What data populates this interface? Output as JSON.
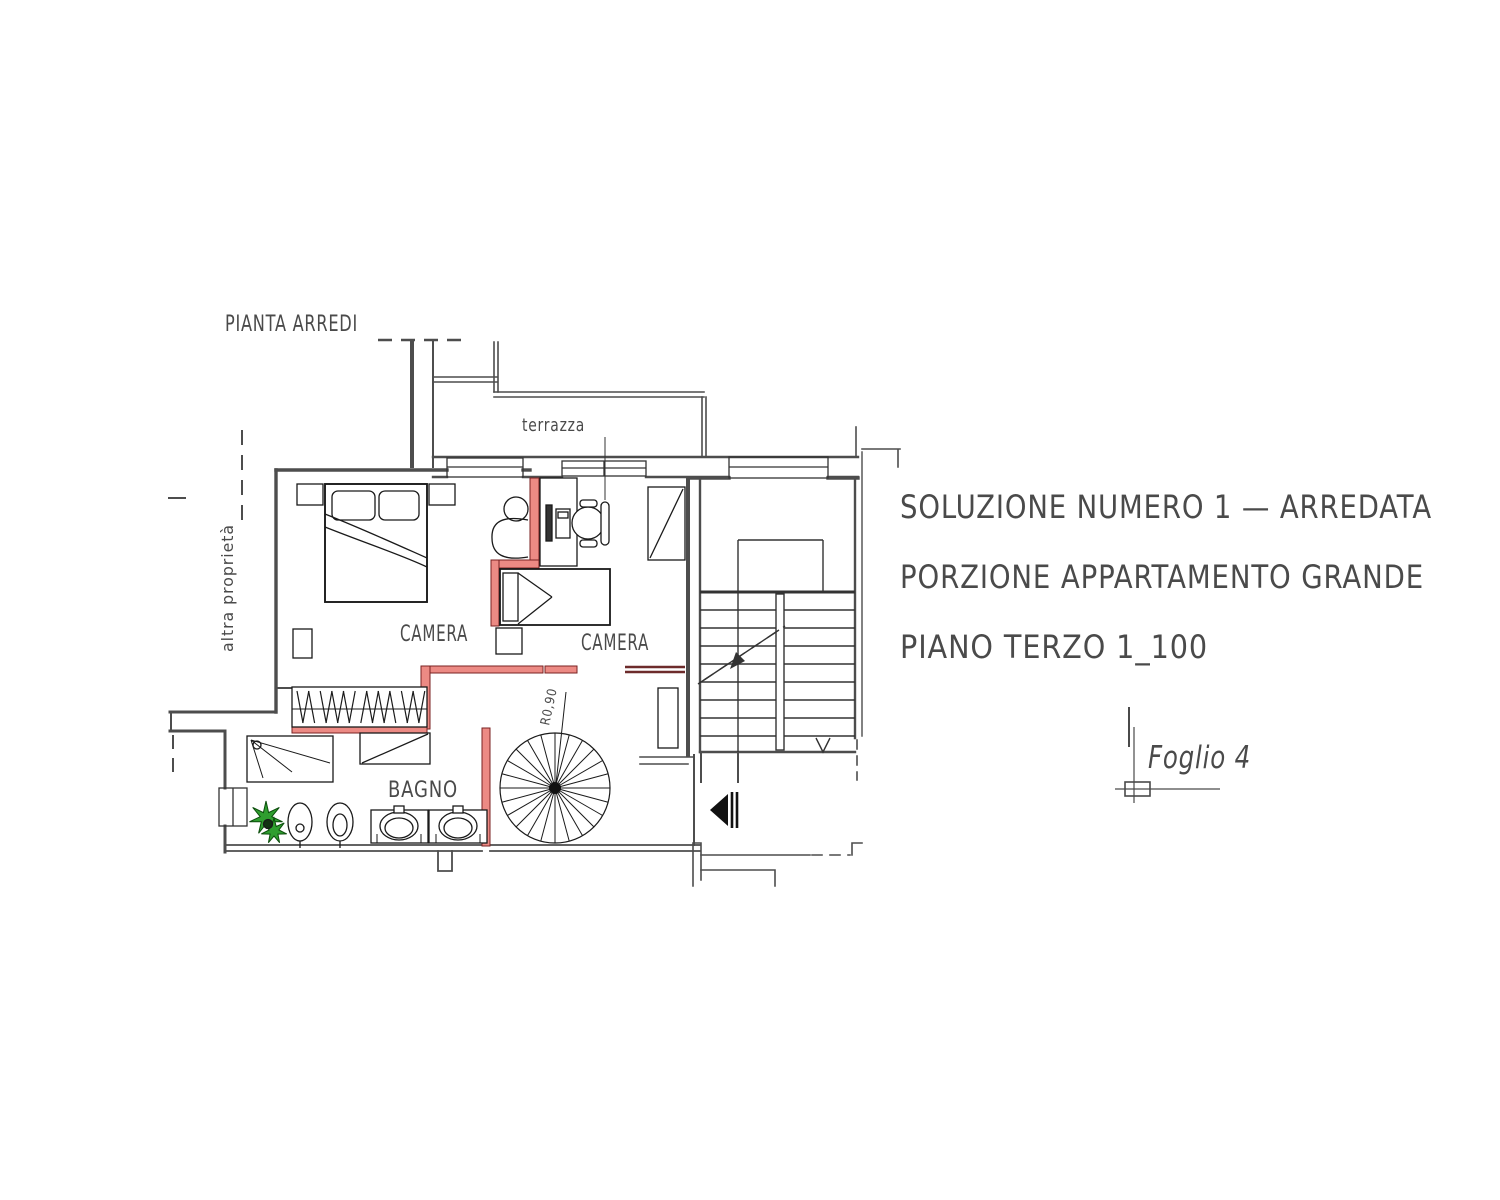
{
  "texts": {
    "drawing_title": "PIANTA ARREDI",
    "terrace": "terrazza",
    "other_property": "altra proprietà",
    "bedroom_1": "CAMERA",
    "bedroom_2": "CAMERA",
    "bathroom": "BAGNO",
    "spiral_radius": "R0,90",
    "solution_line_1": "SOLUZIONE NUMERO 1 — ARREDATA",
    "solution_line_2": "PORZIONE APPARTAMENTO GRANDE",
    "solution_line_3": "PIANO TERZO 1_100",
    "sheet": "Foglio 4"
  },
  "colors": {
    "wall": "#4d4d4d",
    "thin_line": "#333333",
    "furniture_line": "#1a1a1a",
    "new_wall_fill": "#ec8a84",
    "new_wall_stroke": "#7a2222",
    "demolished_wall": "#6d2b2b",
    "plant_fill": "#2f9e2f",
    "plant_stroke": "#0b4d0b",
    "text": "#4a4a4a",
    "background": "#ffffff"
  }
}
